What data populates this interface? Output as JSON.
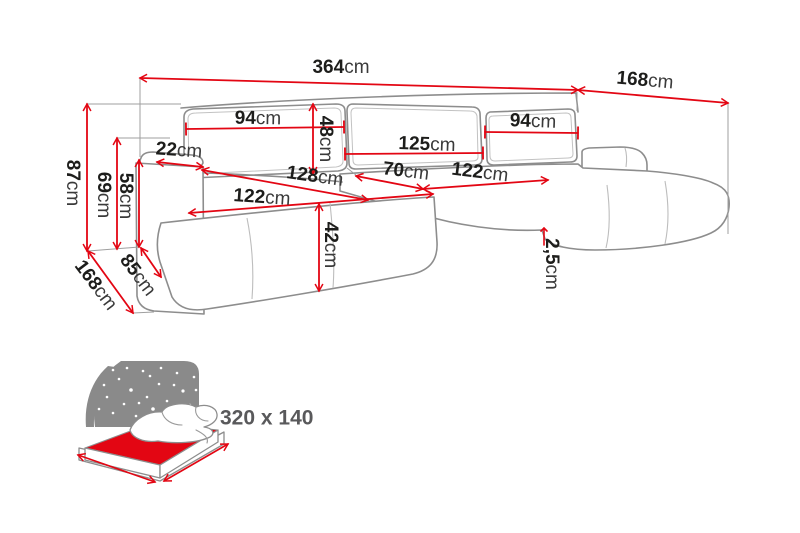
{
  "diagram": {
    "type": "sofa-dimension-drawing",
    "dimensions": [
      {
        "name": "total-width",
        "value": "364",
        "unit": "cm"
      },
      {
        "name": "right-section-depth",
        "value": "168",
        "unit": "cm"
      },
      {
        "name": "total-height",
        "value": "87",
        "unit": "cm"
      },
      {
        "name": "armrest-height",
        "value": "69",
        "unit": "cm"
      },
      {
        "name": "seat-back-height",
        "value": "58",
        "unit": "cm"
      },
      {
        "name": "armrest-width",
        "value": "22",
        "unit": "cm"
      },
      {
        "name": "left-section-depth",
        "value": "168",
        "unit": "cm"
      },
      {
        "name": "armrest-base-depth",
        "value": "85",
        "unit": "cm"
      },
      {
        "name": "back-cushion-left-width",
        "value": "94",
        "unit": "cm"
      },
      {
        "name": "back-cushion-height",
        "value": "48",
        "unit": "cm"
      },
      {
        "name": "back-cushion-middle-width",
        "value": "125",
        "unit": "cm"
      },
      {
        "name": "back-cushion-right-width",
        "value": "94",
        "unit": "cm"
      },
      {
        "name": "chaise-seat-length",
        "value": "128",
        "unit": "cm"
      },
      {
        "name": "seat-width-left",
        "value": "122",
        "unit": "cm"
      },
      {
        "name": "seat-depth-middle",
        "value": "70",
        "unit": "cm"
      },
      {
        "name": "seat-width-right",
        "value": "122",
        "unit": "cm"
      },
      {
        "name": "seat-height",
        "value": "42",
        "unit": "cm"
      },
      {
        "name": "seat-edge-step",
        "value": "2,5",
        "unit": "cm"
      }
    ],
    "sleeping_area": {
      "label": "320 x 140"
    },
    "icons": [
      {
        "name": "sleeping-function-icon"
      }
    ],
    "colors": {
      "dimension_red": "#e30613",
      "outline_gray": "#8d8d8d",
      "icon_gray": "#8a8a8a",
      "text_dark": "#1d1d1b",
      "sleeping_text_gray": "#59595b"
    }
  }
}
